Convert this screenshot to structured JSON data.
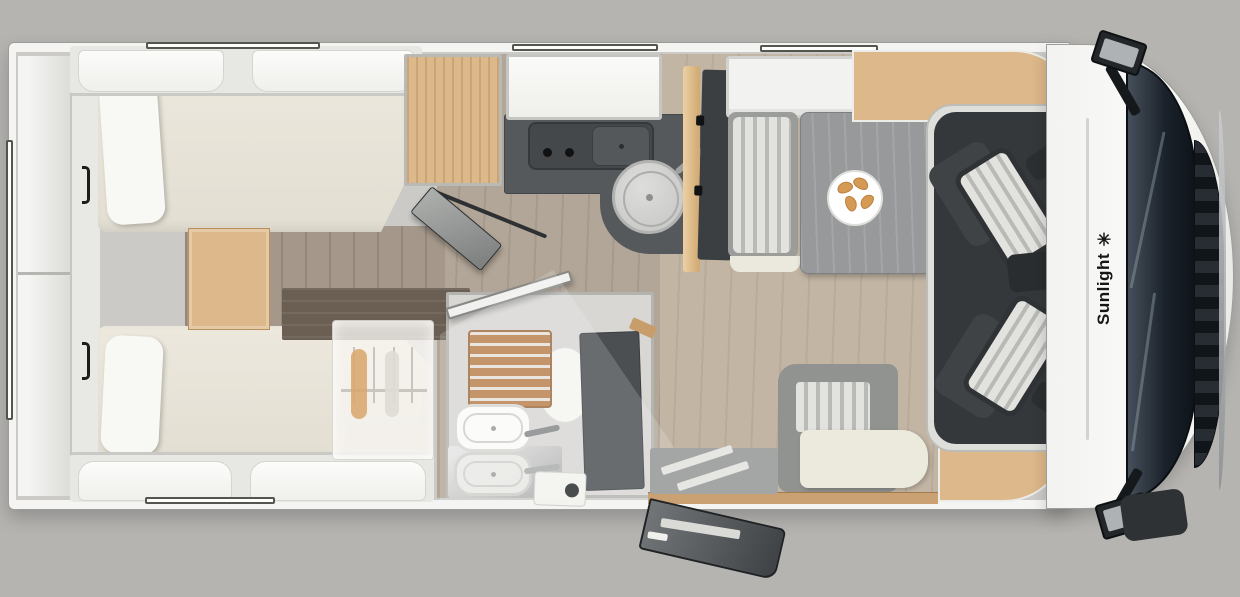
{
  "title": "Motorhome floor plan top view",
  "front": {
    "brand_text": "Sunlight ✳"
  },
  "colors": {
    "background": "#b6b4b1",
    "cab_dark": "#35383b",
    "windshield_dark": "#1a212a",
    "counter_dark": "#56595b",
    "mattress_cream": "#ece8dd",
    "cushion_white": "#f8f8f5",
    "seat_stripe_light": "#e2e2df",
    "seat_stripe_dark": "#b9b9b6",
    "seat_frame_dark": "#3f4346",
    "table_gray": "#97999a",
    "bath_panel_dark": "#4b4f51",
    "shower_wood": "#b97f4e",
    "furniture_wood_light": "#dcb88a",
    "furniture_wood_dark": "#6b5f54",
    "croissant": "#d59a54",
    "logo_black": "#161616"
  }
}
